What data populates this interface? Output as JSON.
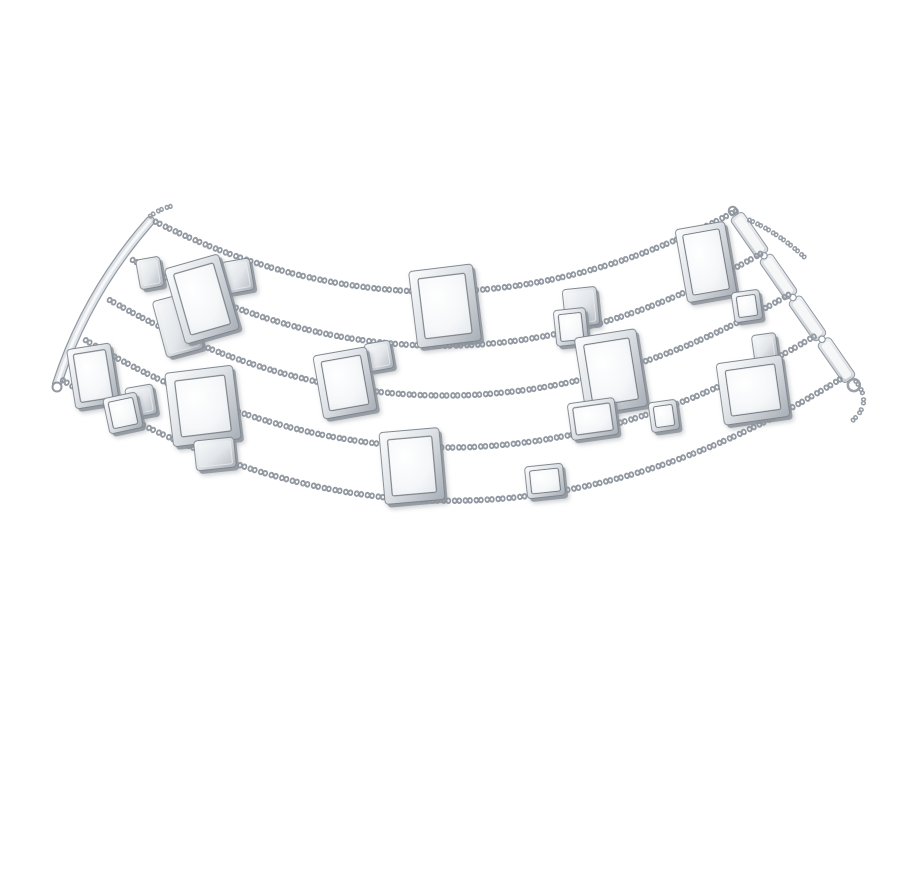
{
  "scene": {
    "subject": "Product photo: five-strand silver chain choker necklace with rectangular mother-of-pearl plaques on a white background",
    "background": "#ffffff",
    "canvas": {
      "width": 904,
      "height": 890
    },
    "link_glyph": "∞",
    "palette": {
      "link_outline": "#8f969f",
      "link_fill": "#ffffff",
      "bezel_light": "#fbfcfd",
      "bezel_mid": "#dfe3e7",
      "bezel_dark": "#a9afb7",
      "mop_light": "#ffffff",
      "mop_mid": "#f5f7f9",
      "mop_dark": "#e4e8ec",
      "plain_light": "#f6f8f9",
      "plain_mid": "#e3e6ea",
      "plain_dark": "#bfc5cb",
      "edge": "#7e858d",
      "thickness": "#8d939b",
      "stone_rim": "#747a82",
      "bar_light": "#f2f4f6",
      "bar_dark": "#c6cbd1",
      "bar_edge": "#9199a1",
      "shadow": "#8d949c"
    }
  },
  "necklace": {
    "strands": [
      {
        "id": "s1",
        "d": "M150,224 Q443,372 736,216"
      },
      {
        "id": "s2",
        "d": "M127,262 Q446,441 764,257"
      },
      {
        "id": "s3",
        "d": "M104,302 Q448,500 792,298"
      },
      {
        "id": "s4",
        "d": "M80,342 Q450,564 820,338"
      },
      {
        "id": "s5",
        "d": "M57,382 Q453,630 849,379"
      }
    ],
    "tails": [
      {
        "id": "t1",
        "d": "M851,381 C862,394 864,406 850,418"
      },
      {
        "id": "t2",
        "d": "M745,222 Q775,235 800,258"
      },
      {
        "id": "t3",
        "d": "M150,221 Q159,213 171,210"
      }
    ],
    "left_bar": {
      "d": "M150,221 Q86,294 57,384",
      "hook": {
        "cx": 57,
        "cy": 387,
        "r": 4.5
      }
    },
    "right_bar": {
      "x1": 735,
      "y1": 214,
      "x2": 851,
      "y2": 381,
      "width": 15,
      "segments": 4
    },
    "plaques": [
      {
        "id": "L2",
        "cx": 150,
        "cy": 273,
        "w": 24,
        "h": 30,
        "rot": -10,
        "kind": "plain"
      },
      {
        "id": "A2",
        "cx": 238,
        "cy": 276,
        "w": 28,
        "h": 32,
        "rot": -10,
        "kind": "plain"
      },
      {
        "id": "B",
        "cx": 178,
        "cy": 325,
        "w": 38,
        "h": 58,
        "rot": -15,
        "kind": "plain"
      },
      {
        "id": "A",
        "cx": 202,
        "cy": 299,
        "w": 56,
        "h": 78,
        "rot": -16,
        "kind": "mop"
      },
      {
        "id": "C",
        "cx": 93,
        "cy": 376,
        "w": 44,
        "h": 60,
        "rot": -9,
        "kind": "mop"
      },
      {
        "id": "D2",
        "cx": 141,
        "cy": 401,
        "w": 28,
        "h": 30,
        "rot": -10,
        "kind": "plain"
      },
      {
        "id": "D1",
        "cx": 123,
        "cy": 413,
        "w": 34,
        "h": 36,
        "rot": -12,
        "kind": "mop"
      },
      {
        "id": "E",
        "cx": 203,
        "cy": 406,
        "w": 68,
        "h": 74,
        "rot": -7,
        "kind": "mop"
      },
      {
        "id": "E2",
        "cx": 215,
        "cy": 454,
        "w": 40,
        "h": 30,
        "rot": -6,
        "kind": "plain"
      },
      {
        "id": "G2",
        "cx": 379,
        "cy": 356,
        "w": 26,
        "h": 28,
        "rot": -10,
        "kind": "plain"
      },
      {
        "id": "G",
        "cx": 345,
        "cy": 383,
        "w": 54,
        "h": 64,
        "rot": -10,
        "kind": "mop"
      },
      {
        "id": "F",
        "cx": 445,
        "cy": 306,
        "w": 64,
        "h": 77,
        "rot": -7,
        "kind": "mop"
      },
      {
        "id": "H",
        "cx": 412,
        "cy": 466,
        "w": 60,
        "h": 72,
        "rot": -5,
        "kind": "mop"
      },
      {
        "id": "I",
        "cx": 545,
        "cy": 481,
        "w": 38,
        "h": 32,
        "rot": -6,
        "kind": "mop"
      },
      {
        "id": "J",
        "cx": 581,
        "cy": 307,
        "w": 34,
        "h": 38,
        "rot": -6,
        "kind": "plain"
      },
      {
        "id": "K",
        "cx": 571,
        "cy": 327,
        "w": 32,
        "h": 36,
        "rot": -6,
        "kind": "mop"
      },
      {
        "id": "C3",
        "cx": 611,
        "cy": 372,
        "w": 62,
        "h": 78,
        "rot": -9,
        "kind": "mop"
      },
      {
        "id": "D4",
        "cx": 593,
        "cy": 419,
        "w": 47,
        "h": 37,
        "rot": -8,
        "kind": "mop"
      },
      {
        "id": "E5",
        "cx": 664,
        "cy": 416,
        "w": 28,
        "h": 30,
        "rot": -8,
        "kind": "mop"
      },
      {
        "id": "P",
        "cx": 706,
        "cy": 262,
        "w": 50,
        "h": 74,
        "rot": -10,
        "kind": "mop"
      },
      {
        "id": "Q",
        "cx": 747,
        "cy": 306,
        "w": 28,
        "h": 30,
        "rot": -8,
        "kind": "mop"
      },
      {
        "id": "R2",
        "cx": 765,
        "cy": 347,
        "w": 24,
        "h": 26,
        "rot": -8,
        "kind": "plain"
      },
      {
        "id": "R",
        "cx": 753,
        "cy": 390,
        "w": 66,
        "h": 62,
        "rot": -8,
        "kind": "mop"
      }
    ]
  }
}
